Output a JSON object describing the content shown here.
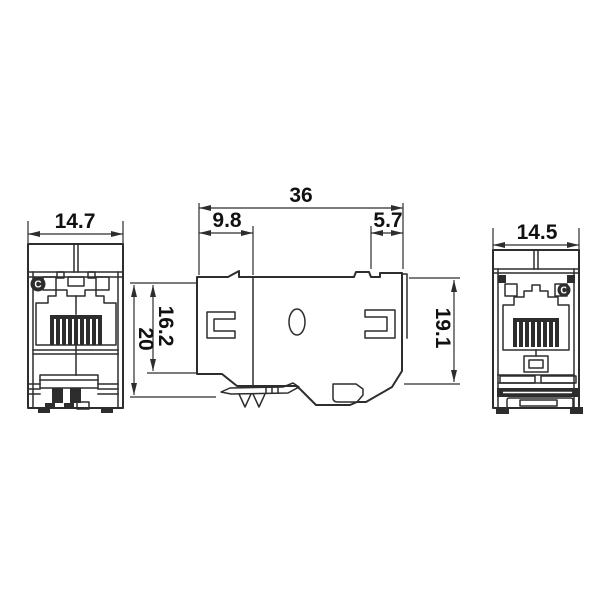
{
  "colors": {
    "line": "#2d2d2d",
    "background": "#ffffff",
    "text": "#111111"
  },
  "dimensions": {
    "front_width": "14.7",
    "side_total_width": "36",
    "side_front_section": "9.8",
    "side_rear_tab": "5.7",
    "side_inner_height": "16.2",
    "side_total_height": "20",
    "side_rear_height": "19.1",
    "rear_width": "14.5"
  },
  "marks": {
    "front_circle_letter": "C",
    "rear_circle_letter": "C"
  }
}
